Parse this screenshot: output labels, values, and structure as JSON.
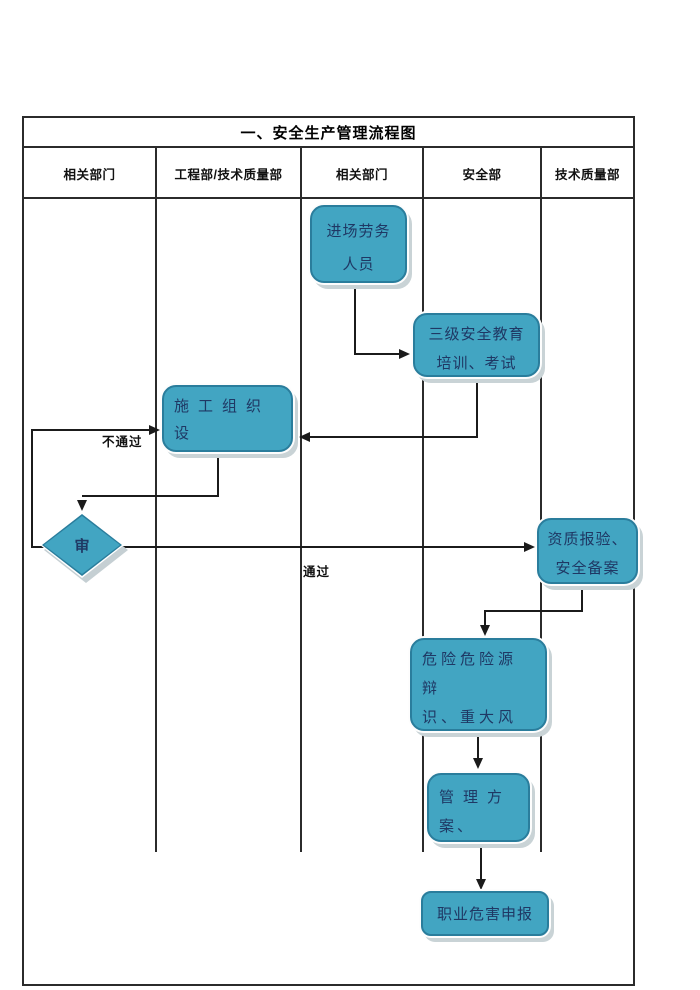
{
  "title": "一、安全生产管理流程图",
  "columns": [
    "相关部门",
    "工程部/技术质量部",
    "相关部门",
    "安全部",
    "技术质量部"
  ],
  "nodes": {
    "entry_labor": {
      "lines": [
        "进场劳务",
        "人员"
      ]
    },
    "education": {
      "lines": [
        "三级安全教育",
        "培训、考试"
      ]
    },
    "construction_design": {
      "lines": [
        "施工组织设",
        "计、安全专项",
        "方案"
      ]
    },
    "review_diamond": {
      "label": "审"
    },
    "qualification": {
      "lines": [
        "资质报验、",
        "安全备案"
      ]
    },
    "hazard_list": {
      "lines": [
        "危险危险源辩",
        "识、重大风险",
        "清单"
      ]
    },
    "management_plan": {
      "lines": [
        "管理方",
        "案、"
      ]
    },
    "occupational_hazard": {
      "label": "职业危害申报"
    }
  },
  "edge_labels": {
    "fail": "不通过",
    "pass": "通过"
  },
  "colors": {
    "node_fill": "#42a5c2",
    "node_border": "#2a7d9c",
    "node_text": "#1f3864",
    "grid_line": "#2b2b2b",
    "connector": "#1b1b1b",
    "shadow": "#c9d3d6"
  }
}
